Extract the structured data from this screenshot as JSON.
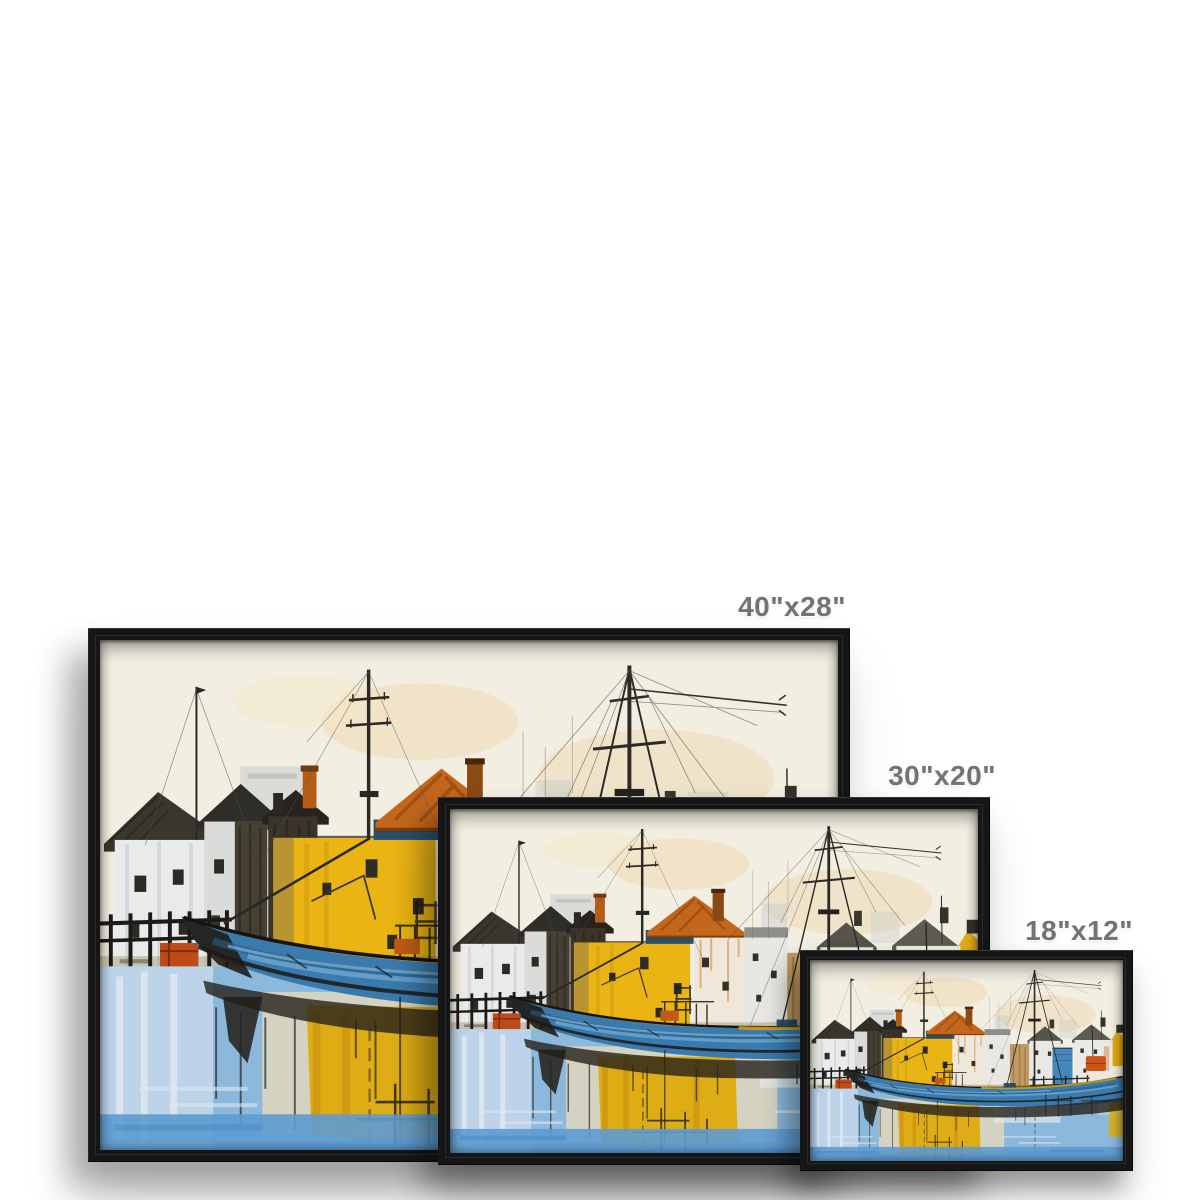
{
  "page": {
    "background_color": "#ffffff"
  },
  "mockup": {
    "description": "Black floating-frame canvas prints of a harbour painting shown in three sizes",
    "frame_color": "#161616",
    "label_color": "#737373",
    "sizes": [
      {
        "label": "40\"x28\"",
        "width_in": 40,
        "height_in": 28
      },
      {
        "label": "30\"x20\"",
        "width_in": 30,
        "height_in": 20
      },
      {
        "label": "18\"x12\"",
        "width_in": 18,
        "height_in": 12
      }
    ],
    "artwork": {
      "subject": "Abstract harbour scene: blue fishing boat, yellow building, orange roofs, masts and water reflections",
      "palette": {
        "sky_cream": "#f2eee2",
        "building_yellow": "#e9b414",
        "roof_orange": "#c4671c",
        "boat_blue": "#3a7aac",
        "water_blue": "#8cb8dc",
        "ink_dark": "#26221c"
      }
    }
  }
}
